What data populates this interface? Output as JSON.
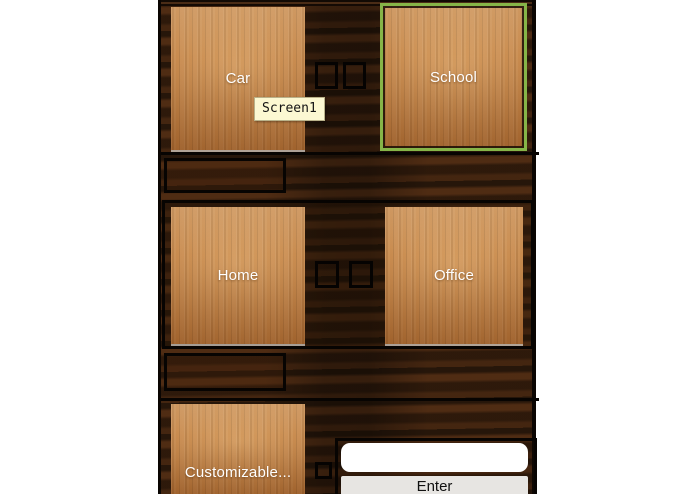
{
  "theme": {
    "page_background": "#ffffff",
    "dark_wood": "#38200e",
    "light_wood": "#c4803f",
    "selection_border": "#86b548",
    "checkbox_border": "#050302",
    "tooltip_background": "#fcf8d2",
    "button_background": "#e7e5e2",
    "panel_text_color": "#ffffff"
  },
  "tooltip": {
    "text": "Screen1"
  },
  "panels": {
    "car": {
      "label": "Car",
      "selected": false
    },
    "school": {
      "label": "School",
      "selected": true
    },
    "home": {
      "label": "Home",
      "selected": false
    },
    "office": {
      "label": "Office",
      "selected": false
    },
    "customizable": {
      "label": "Customizable...",
      "selected": false
    }
  },
  "checkboxes": [
    {
      "id": "row1-left",
      "checked": false
    },
    {
      "id": "row1-right",
      "checked": false
    },
    {
      "id": "row2-left",
      "checked": false
    },
    {
      "id": "row2-right",
      "checked": false
    },
    {
      "id": "row3",
      "checked": false
    }
  ],
  "form": {
    "input_value": "",
    "button_label": "Enter"
  }
}
